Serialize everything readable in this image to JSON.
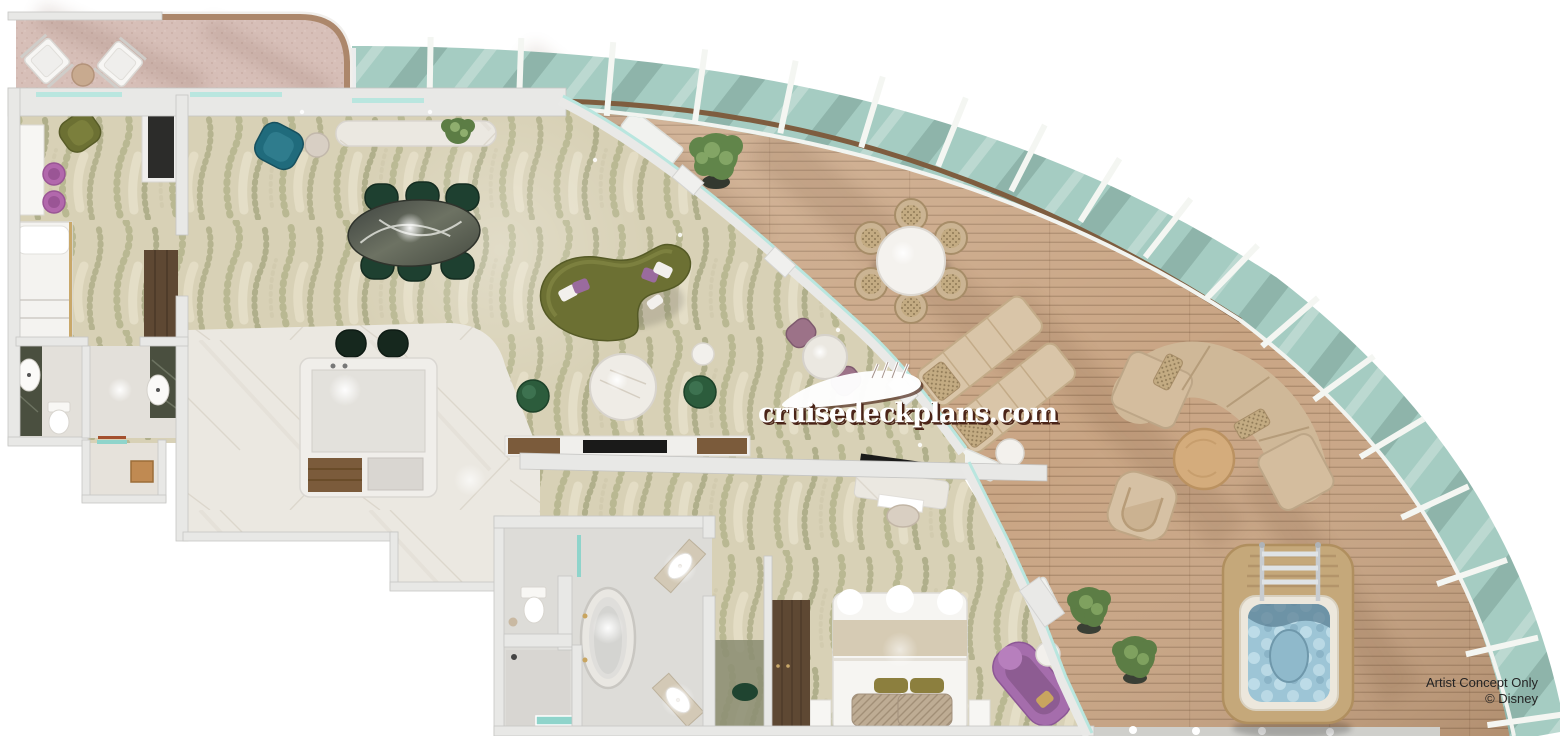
{
  "watermark": {
    "text": "cruisedeckplans.com",
    "logo_icon": "cruise-ship-logo"
  },
  "attribution": {
    "line1": "Artist Concept Only",
    "line2": "© Disney"
  },
  "palette": {
    "background": "#ffffff",
    "deck_wood": "#c9a584",
    "glass_railing": "#a5ccc2",
    "carpet_base": "#d8d1b6",
    "carpet_leaf": "#9aa06e",
    "carpet_leaf_dark": "#7f8656",
    "marble_floor": "#ebe8e1",
    "marble_vein": "#cfc8bb",
    "wall": "#e8e8e6",
    "pink_veranda": "#d7bfb8",
    "veranda_trim": "#ac876b",
    "olive_sofa": "#6c7033",
    "dining_chair_green": "#1e4030",
    "teal_chair": "#206b7c",
    "purple_accent": "#b268ac",
    "chaise_purple": "#a56dac",
    "bar_stool_green": "#16281e",
    "wood_cabinet": "#5e4833",
    "island_wood": "#7b5b3b",
    "outdoor_beige": "#d2bb9b",
    "hot_tub_frame": "#c5a87a",
    "hot_tub_water": "#9dc5d6",
    "plant_green": "#61854a",
    "bed_linen": "#f6f5f2",
    "bed_band": "#d6cbb4",
    "railing_rail_wood": "#7e5d3f",
    "watermark_white": "#ffffff",
    "watermark_shadow": "#4a2418",
    "attribution_text": "#242424"
  },
  "scene": {
    "type": "cruise-suite-floor-plan",
    "areas": [
      "private-veranda",
      "guest-bedroom",
      "guest-bathroom",
      "entry-vestibule",
      "kitchen-pantry",
      "dining-area",
      "living-area",
      "master-bathroom",
      "master-bedroom",
      "walk-in-closet",
      "wrap-around-balcony"
    ],
    "furniture": [
      "veranda-lounge-chairs",
      "single-bed",
      "vanity-desk",
      "oval-dining-table",
      "dining-chairs",
      "curved-olive-sofa",
      "round-coffee-table",
      "kitchen-island",
      "bar-stools",
      "bistro-table",
      "freestanding-bathtub",
      "double-vanity",
      "toilet",
      "king-bed",
      "writing-desk",
      "purple-chaise",
      "wardrobe",
      "outdoor-round-table",
      "outdoor-chairs",
      "sun-loungers",
      "outdoor-sectional",
      "outdoor-armchair",
      "outdoor-coffee-table",
      "hot-tub",
      "potted-plants"
    ]
  }
}
